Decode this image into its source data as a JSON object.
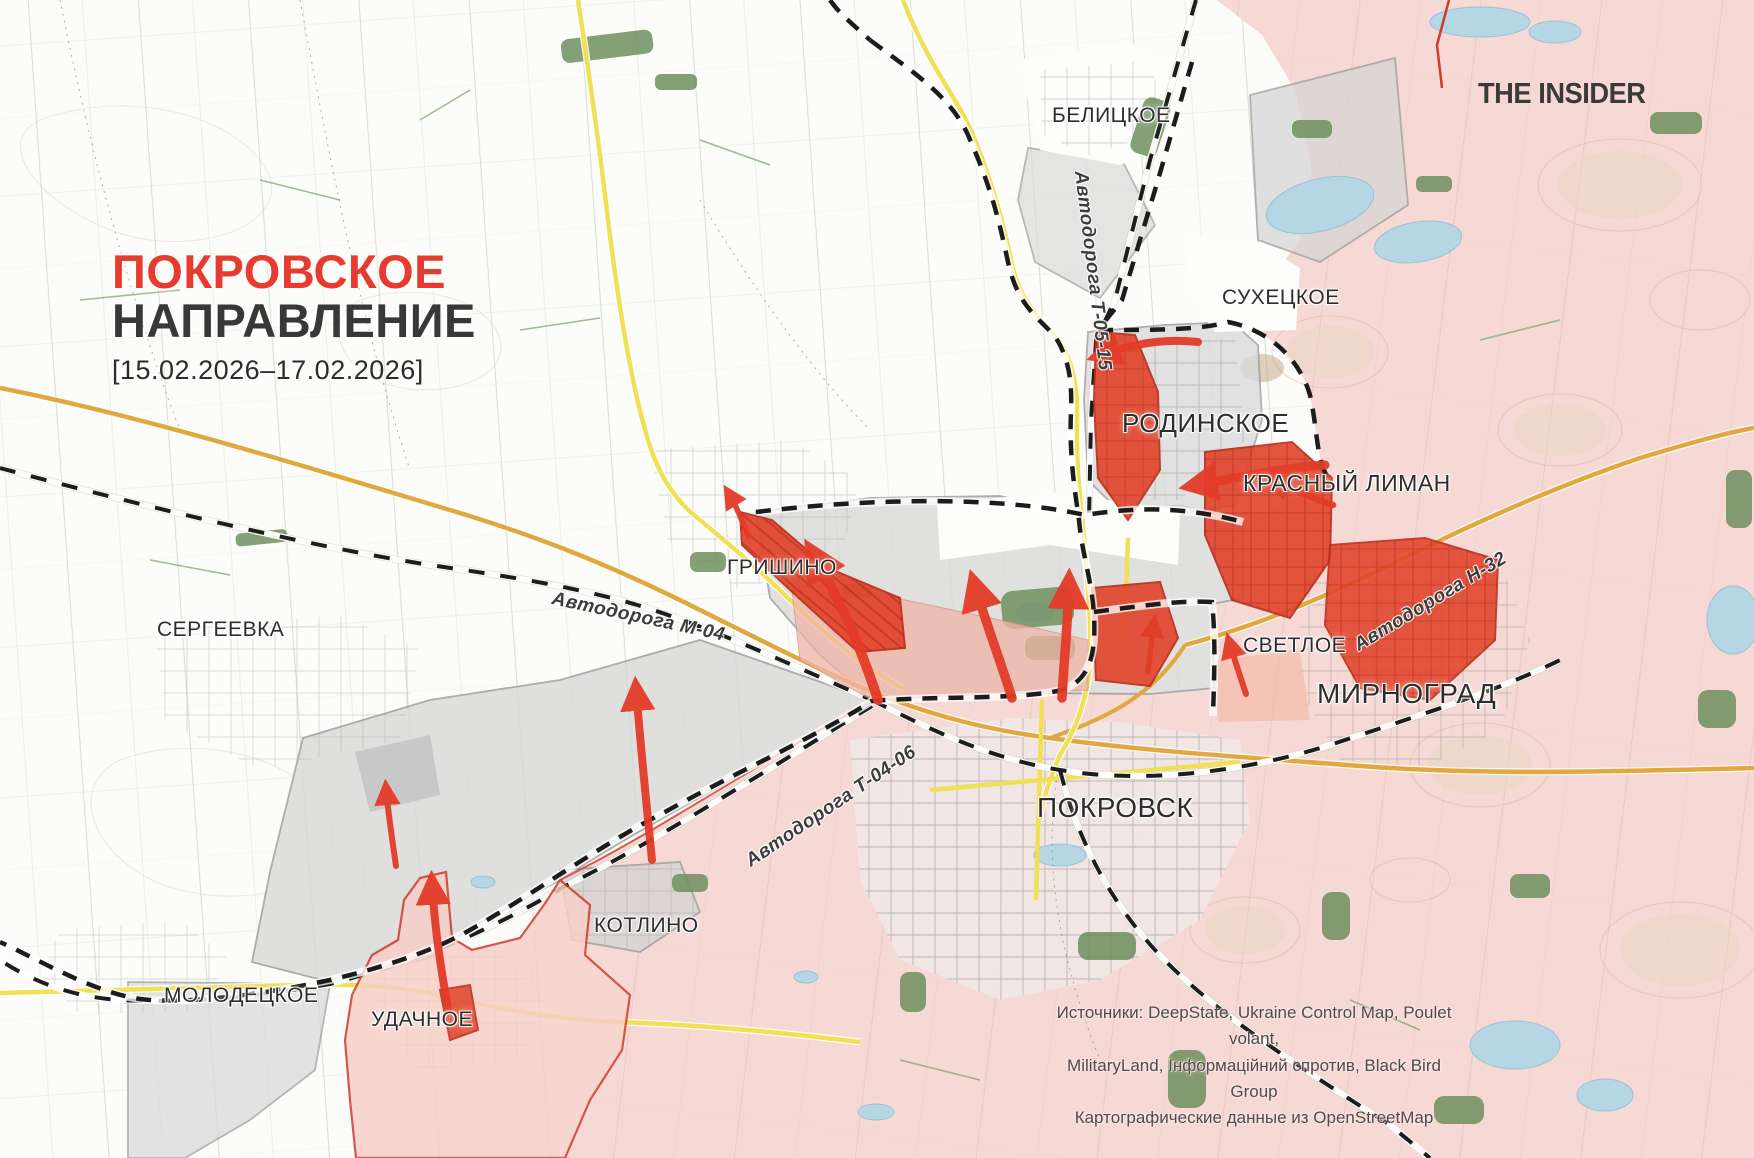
{
  "title": {
    "line1": "ПОКРОВСКОЕ",
    "line2": "НАПРАВЛЕНИЕ",
    "dates": "[15.02.2026–17.02.2026]"
  },
  "branding": {
    "logo": "THE INSIDER"
  },
  "map": {
    "places": [
      {
        "id": "belitskoe",
        "label": "БЕЛИЦКОЕ"
      },
      {
        "id": "sukhetskoe",
        "label": "СУХЕЦКОЕ"
      },
      {
        "id": "rodinskoe",
        "label": "РОДИНСКОЕ"
      },
      {
        "id": "krasny-liman",
        "label": "КРАСНЫЙ ЛИМАН"
      },
      {
        "id": "grishino",
        "label": "ГРИШИНО"
      },
      {
        "id": "sergeevka",
        "label": "СЕРГЕЕВКА"
      },
      {
        "id": "svetloe",
        "label": "СВЕТЛОЕ"
      },
      {
        "id": "mirnograd",
        "label": "МИРНОГРАД"
      },
      {
        "id": "pokrovsk",
        "label": "ПОКРОВСК"
      },
      {
        "id": "kotlino",
        "label": "КОТЛИНО"
      },
      {
        "id": "molodetskoe",
        "label": "МОЛОДЕЦКОЕ"
      },
      {
        "id": "udachnoe",
        "label": "УДАЧНОЕ"
      }
    ],
    "road_labels": [
      {
        "id": "t-05-15",
        "label": "Автодорога Т-05-15"
      },
      {
        "id": "m-04",
        "label": "Автодорога М-04"
      },
      {
        "id": "n-32",
        "label": "Автодорога Н-32"
      },
      {
        "id": "t-04-06",
        "label": "Автодорога Т-04-06"
      }
    ],
    "colors": {
      "advance_red": "#e23b28",
      "occupied_pink": "#f6d9d4",
      "contested_gray": "#dadada",
      "frontline_black": "#1c1c1c",
      "title_red": "#e63b2e",
      "water_blue": "#b5d6e4"
    }
  },
  "sources": {
    "line1": "Источники: DeepState, Ukraine Control Map, Poulet volant,",
    "line2": "MilitaryLand, Інформаційний спротив, Black Bird Group",
    "line3": "Картографические данные из OpenStreetMap"
  }
}
